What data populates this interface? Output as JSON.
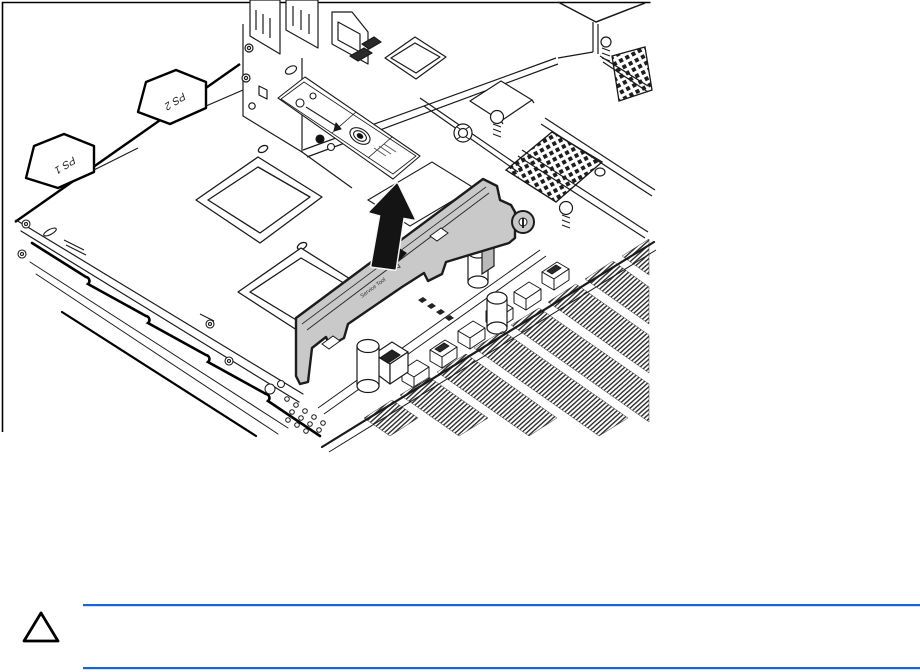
{
  "page": {
    "background": "#ffffff"
  },
  "figure": {
    "alt": "Isometric line drawing of a server chassis: the power supply air baffle (shaded gray) is lifted out of the chassis, indicated by a large upward black arrow. Power supply cage labeled PS 1 and PS 2, system board with heatsink and DIMM slot banks at right.",
    "labels": {
      "ps1": "PS 1",
      "ps2": "PS 2",
      "baffle_marking": "Service Tool"
    },
    "colors": {
      "line": "#1a1a1a",
      "baffle_fill": "#c9c9c9",
      "arrow_fill": "#141414"
    }
  },
  "caution": {
    "icon": "caution-triangle",
    "rule_color": "#1565d9",
    "text": ""
  }
}
